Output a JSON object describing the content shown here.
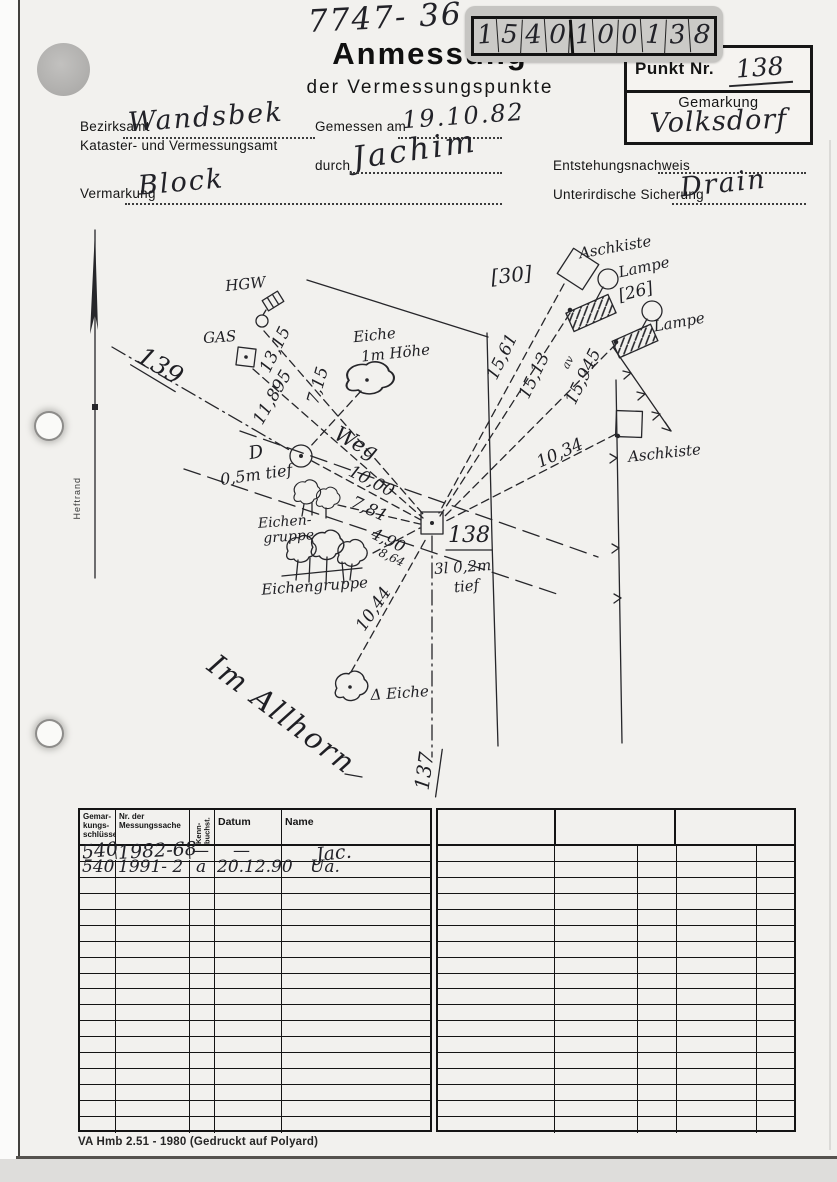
{
  "page": {
    "ref_number": "7747- 36",
    "digit_grid": [
      "1",
      "5",
      "4",
      "0",
      "1",
      "0",
      "0",
      "1",
      "3",
      "8"
    ],
    "title": "Anmessung",
    "subtitle": "der Vermessungspunkte",
    "punkt": {
      "label": "Punkt Nr.",
      "value": "138",
      "gemarkung_label": "Gemarkung",
      "gemarkung_value": "Volksdorf"
    },
    "fields": {
      "bezirksamt_label": "Bezirksamt",
      "bezirksamt_value": "Wandsbek",
      "kataster_label": "Kataster- und Vermessungsamt",
      "gemessen_label": "Gemessen am",
      "gemessen_value": "19.10.82",
      "durch_label": "durch",
      "durch_value": "Jachim",
      "entstehung_label": "Entstehungsnachweis",
      "vermarkung_label": "Vermarkung",
      "vermarkung_value": "Block",
      "sicherung_label": "Unterirdische Sicherung",
      "sicherung_value": "Drain"
    },
    "margin_note": "Heftrand",
    "footer": "VA Hmb 2.51 - 1980 (Gedruckt auf Polyard)"
  },
  "sketch": {
    "labels": {
      "parcel30": "[30]",
      "aschkiste_top": "Aschkiste",
      "lampe1": "Lampe",
      "parcel26": "[26]",
      "lampe2": "Lampe",
      "m1561": "15,61",
      "m1513": "15,13",
      "av": "av",
      "m15945": "15,945",
      "m1034": "10,34",
      "aschkiste_right": "Aschkiste",
      "hgw": "HGW",
      "gas": "GAS",
      "eiche": "Eiche",
      "eiche_hoehe": "1m Höhe",
      "m1315": "13,15",
      "m11895": "11,895",
      "m715": "7,15",
      "weg": "Weg",
      "p139": "139",
      "d_mark": "D",
      "d_tief": "0,5m tief",
      "m1000": "10,00",
      "m781": "7,81",
      "m490": "4,90",
      "m864": "8,64",
      "eichengruppe1a": "Eichen-",
      "eichengruppe1b": "gruppe",
      "eichengruppe2": "Eichengruppe",
      "m1044": "10,44",
      "eiche_bottom": "Δ Eiche",
      "p138": "138",
      "p138_note1": "3l 0,2m",
      "p138_note2": "tief",
      "p137": "137",
      "street": "Im Allhorn"
    }
  },
  "table": {
    "left_headers": {
      "c1": "Gemar-\nkungs-\nschlüssel",
      "c2": "Nr. der\nMessungssache",
      "c3": "Kenn-buchst.",
      "c4": "Datum",
      "c5": "Name"
    },
    "rows": [
      [
        "540",
        "1982-68",
        "—",
        "—",
        "Jac."
      ],
      [
        "540",
        "1991- 2",
        "a",
        "20.12.90",
        "Ua."
      ]
    ],
    "left_empty_rows": 16,
    "right_empty_rows": 18
  }
}
